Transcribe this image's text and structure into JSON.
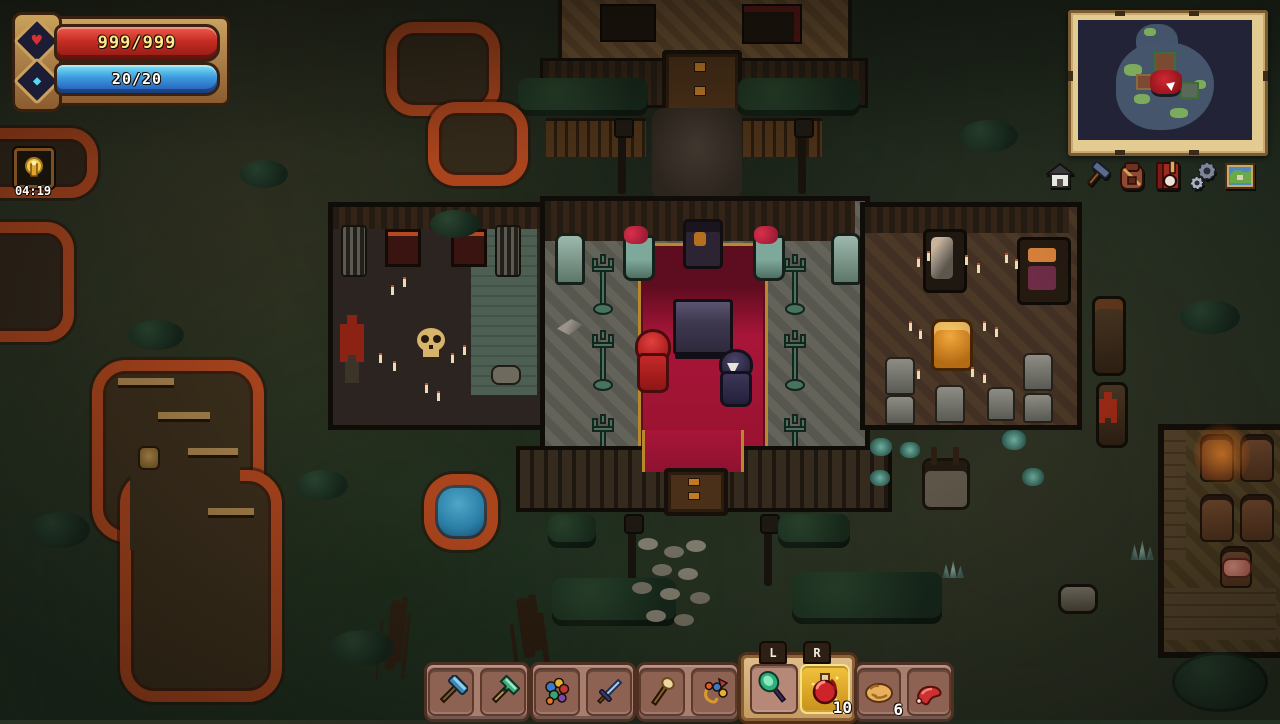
{
  "hud": {
    "health": {
      "display": "999/999",
      "bar_color": "#c42c24",
      "text_color": "#ffe98a",
      "icon": "heart-icon"
    },
    "mana": {
      "display": "20/20",
      "bar_color": "#3c9ade",
      "text_color": "#ffffff",
      "icon": "gem-icon"
    },
    "timer": {
      "value": "04:19",
      "icon": "lantern-icon"
    },
    "minimap": {
      "frame_color": "#e3cb92",
      "bg_color": "#232338",
      "island_color": "#45556b",
      "vegetation_color": "#7cab5e",
      "player_area_color": "#b01d26",
      "player_marker_color": "#ffffff"
    },
    "menu_icons": [
      {
        "name": "home-icon"
      },
      {
        "name": "tools-icon"
      },
      {
        "name": "backpack-icon"
      },
      {
        "name": "journal-icon"
      },
      {
        "name": "settings-icon"
      },
      {
        "name": "map-icon"
      }
    ],
    "hotbar": {
      "left_tab": "L",
      "right_tab": "R",
      "groups": [
        {
          "slots": [
            {
              "icon": "blue-hammer"
            },
            {
              "icon": "green-axe"
            }
          ]
        },
        {
          "slots": [
            {
              "icon": "flower-bundle"
            },
            {
              "icon": "blue-sword"
            }
          ]
        },
        {
          "slots": [
            {
              "icon": "torch"
            },
            {
              "icon": "fishing-lure"
            }
          ]
        },
        {
          "active": true,
          "slots": [
            {
              "icon": "green-shovel"
            },
            {
              "icon": "red-potion",
              "count": "10",
              "selected": true
            }
          ]
        },
        {
          "slots": [
            {
              "icon": "bread",
              "count": "6"
            },
            {
              "icon": "raw-meat"
            }
          ]
        }
      ]
    }
  },
  "scene": {
    "location": "church-at-night",
    "characters": [
      {
        "name": "player-red-hood"
      },
      {
        "name": "npc-dark-robe"
      }
    ],
    "palette": {
      "grass": "#243224",
      "carpet": "#a81538",
      "carpet_trim": "#c9a23a",
      "stone_floor": "#63635a",
      "autumn_leaves": "#a9441d",
      "pond": "#2a7fa8"
    }
  }
}
